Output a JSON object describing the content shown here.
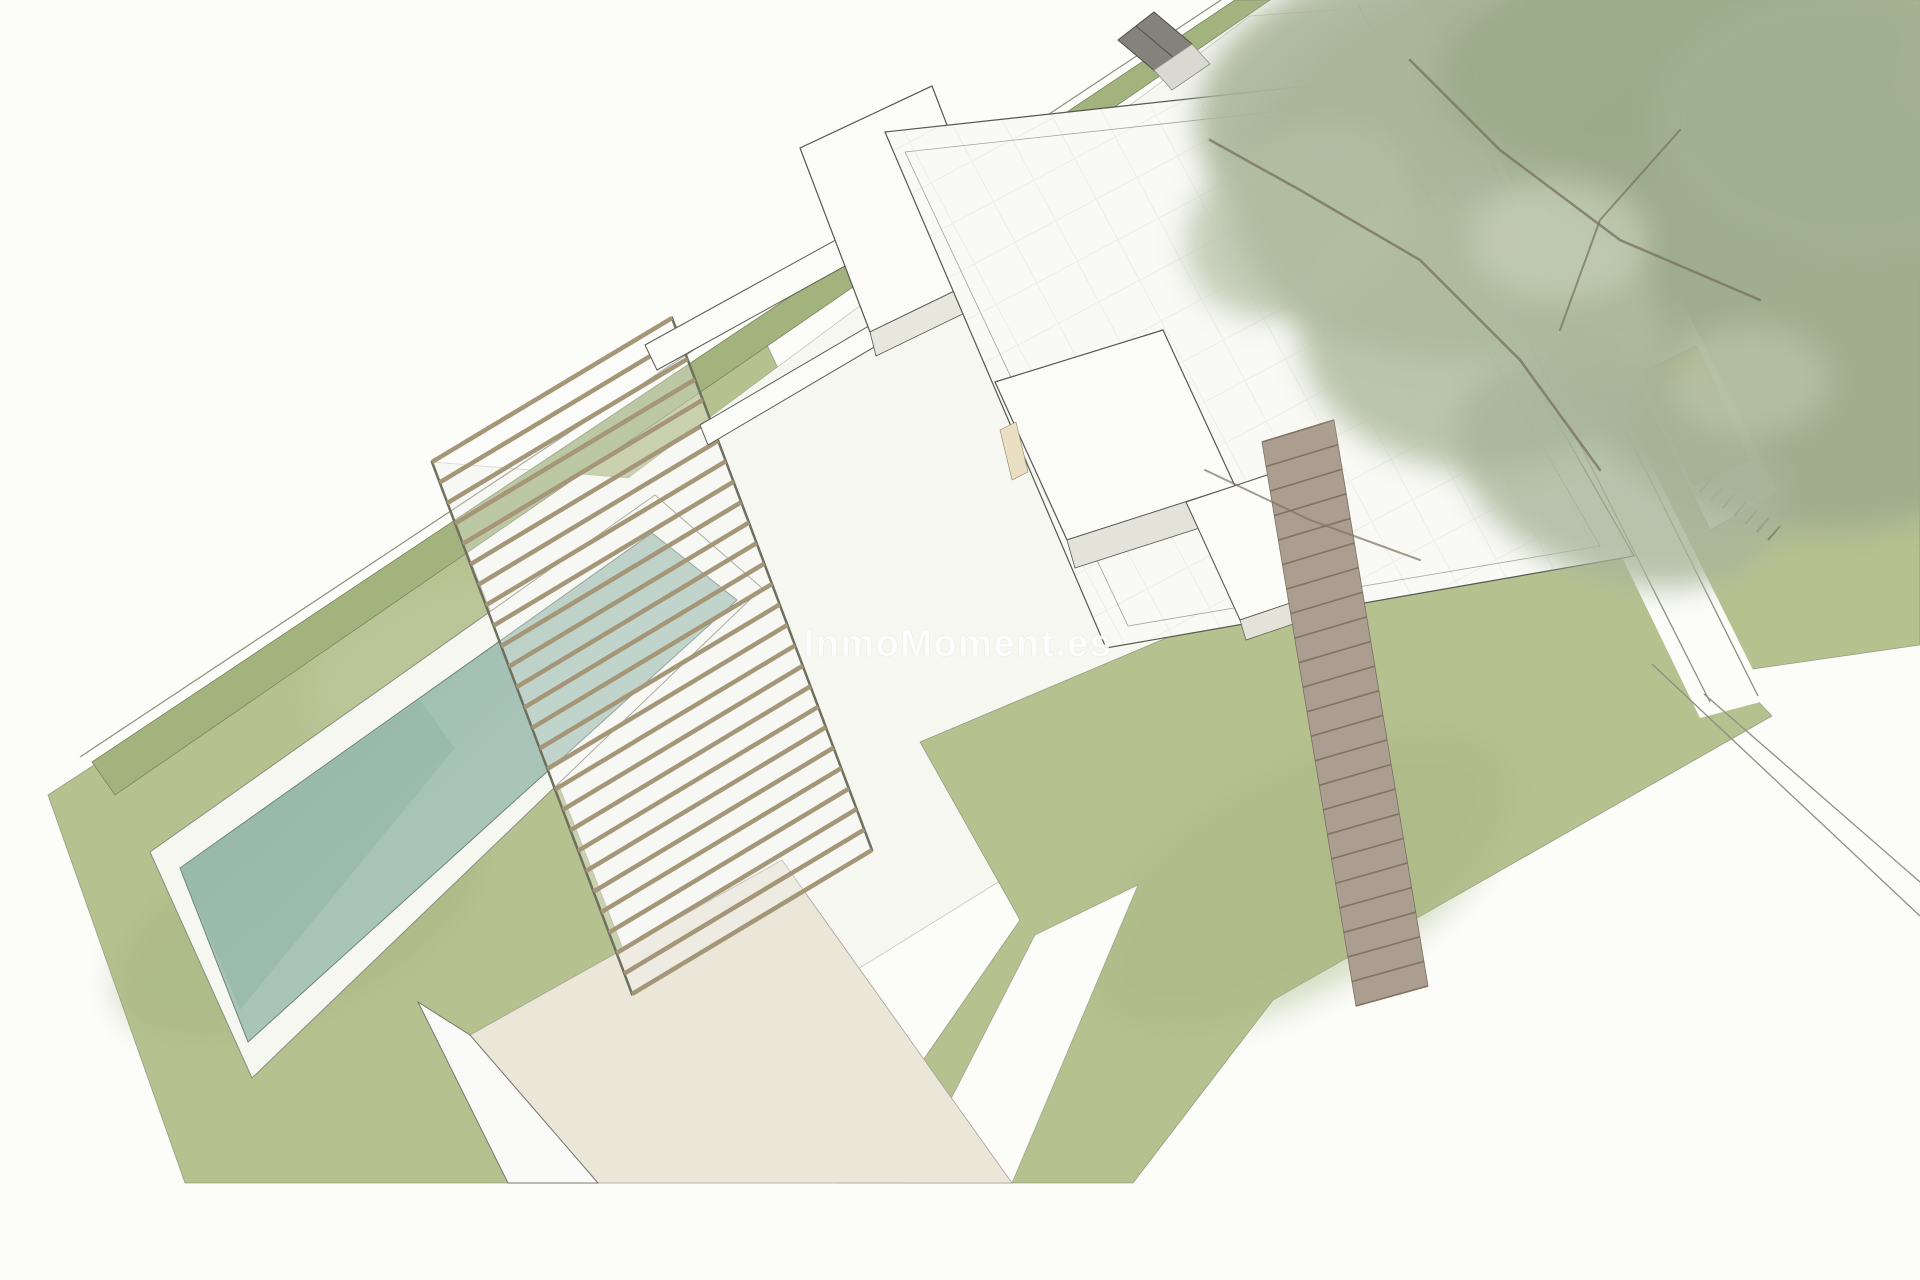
{
  "meta": {
    "description": "Aerial axonometric architectural rendering of a modern villa plot with lawn, pool, pergola, flat-roofed volumes, access ramp, large pine tree and garden furniture",
    "canvas_width": 1920,
    "canvas_height": 1280
  },
  "watermark": {
    "text": "InmoMoment.es",
    "x": 958,
    "y": 656,
    "font_size": 38,
    "fill": "#ffffff",
    "opacity": 0.85,
    "stroke": "rgba(185,185,178,0.28)"
  },
  "palette": {
    "paper": "#fcfcf9",
    "lawn": "#b6c190",
    "lawn_edge": "rgba(105,112,90,0.55)",
    "hedge": "#a3b37e",
    "paving": "#f7f7f2",
    "volume_white": "#fbfbf8",
    "volume_outline": "#56584e",
    "pool_teal": "#9fbfb3",
    "pergola_slat": "#a69678",
    "ramp_brown": "#ab9d8f",
    "beige_terrace": "#eae7d9",
    "tree_green": "#a6b296",
    "lounger_orange": "#dfa33e",
    "hut_grey": "#83827c",
    "path_line": "#8c9080"
  },
  "scene": {
    "shapes": [
      {
        "name": "lawn-west",
        "type": "polygon",
        "points": "48,795 760,330 808,432 560,1183 185,1183",
        "fill": "#b6c190",
        "stroke": "rgba(105,112,90,0.55)",
        "width": 0.8
      },
      {
        "name": "lawn-east",
        "type": "polygon",
        "points": "1400,0 1920,0 1920,645 1662,682 1452,138",
        "fill": "#b6c190",
        "stroke": "rgba(105,112,90,0.55)",
        "width": 0.8
      },
      {
        "name": "lawn-mottle-light",
        "type": "ellipse",
        "cx": 450,
        "cy": 660,
        "rx": 150,
        "ry": 80,
        "rot": -20,
        "fill": "#c2cba4",
        "opacity": 0.4,
        "filter": "soft"
      },
      {
        "name": "lawn-mottle-dark",
        "type": "ellipse",
        "cx": 300,
        "cy": 920,
        "rx": 200,
        "ry": 95,
        "rot": -25,
        "fill": "#a6b682",
        "opacity": 0.45,
        "filter": "soft"
      },
      {
        "name": "central-paving",
        "type": "polygon",
        "points": "432,462 628,478 1250,16 1360,8 1680,610 1642,668 1400,740 1050,850 800,1005 640,992",
        "fill": "#f7f7f2",
        "stroke": "rgba(120,125,108,0.4)",
        "width": 0.8
      },
      {
        "name": "lawn-south",
        "type": "polygon",
        "points": "920,742 1545,478 1772,716 1273,1000 1133,1183 838,1183 1020,920",
        "fill": "#b6c190",
        "stroke": "rgba(105,112,90,0.55)",
        "width": 0.8
      },
      {
        "name": "lawn-south-mottle",
        "type": "ellipse",
        "cx": 1300,
        "cy": 880,
        "rx": 240,
        "ry": 110,
        "rot": -30,
        "fill": "#a8b884",
        "opacity": 0.45,
        "filter": "soft"
      },
      {
        "name": "garden-path",
        "type": "polygon",
        "points": "1035,935 1138,885 1012,1183 908,1183",
        "fill": "#fcfcf9",
        "stroke": "rgba(120,125,108,0.5)",
        "width": 0.8
      },
      {
        "name": "driveway-road",
        "type": "polygon",
        "points": "1352,0 1420,0 1768,700 1700,718",
        "fill": "#fcfcf9",
        "stroke": "none",
        "width": 0
      },
      {
        "name": "boundary-line-outer",
        "type": "line",
        "x1": 80,
        "y1": 757,
        "x2": 1230,
        "y2": -6,
        "stroke": "#8c9080",
        "width": 1.2
      },
      {
        "name": "road-edge-left",
        "type": "line",
        "x1": 1358,
        "y1": 4,
        "x2": 1710,
        "y2": 702,
        "stroke": "#8c9080",
        "width": 1.3
      },
      {
        "name": "road-edge-right",
        "type": "line",
        "x1": 1412,
        "y1": 2,
        "x2": 1758,
        "y2": 696,
        "stroke": "#8c9080",
        "width": 1.3
      },
      {
        "name": "junction-line-a",
        "type": "line",
        "x1": 1704,
        "y1": 694,
        "x2": 1920,
        "y2": 882,
        "stroke": "#8c9080",
        "width": 1.3
      },
      {
        "name": "junction-line-b",
        "type": "line",
        "x1": 1652,
        "y1": 664,
        "x2": 1920,
        "y2": 916,
        "stroke": "#8c9080",
        "width": 1.3
      },
      {
        "name": "hedge-strip",
        "type": "polygon",
        "points": "92,762 1235,0 1270,0 115,795",
        "fill": "#a3b37e",
        "stroke": "#79855f",
        "width": 0.8
      },
      {
        "name": "pool-deck",
        "type": "polygon",
        "points": "150,852 655,495 762,588 252,1078",
        "fill": "#f7f7f2",
        "stroke": "#8a8e7e",
        "width": 1
      },
      {
        "name": "pool-water",
        "type": "polygon",
        "points": "180,868 652,533 737,600 248,1042",
        "fill": "url(#gwater)",
        "stroke": "#6a857a",
        "width": 1
      },
      {
        "name": "pool-water-shade",
        "type": "polygon",
        "points": "180,868 420,700 455,748 240,1010",
        "fill": "#8fb2a4",
        "stroke": "none",
        "width": 0,
        "opacity": 0.45
      },
      {
        "name": "sunken-terrace",
        "type": "polygon",
        "points": "470,1035 782,860 1012,1183 598,1183",
        "fill": "#eae7d9",
        "stroke": "#a2a294",
        "width": 0.8
      },
      {
        "name": "terrace-wall",
        "type": "polygon",
        "points": "418,1002 470,1035 598,1183 508,1183",
        "fill": "#fafaf8",
        "stroke": "#75786a",
        "width": 1
      },
      {
        "name": "pergola-frame",
        "type": "polygon",
        "points": "432,462 672,318 872,850 632,994",
        "fill": "rgba(250,250,247,0.3)",
        "stroke": "#6e705f",
        "width": 2.5
      },
      {
        "name": "pergola-slats",
        "type": "slats",
        "a1": [
          432,
          462
        ],
        "a2": [
          632,
          994
        ],
        "b1": [
          672,
          318
        ],
        "b2": [
          872,
          850
        ],
        "count": 27,
        "stroke": "#a69678",
        "width": 4.5
      },
      {
        "name": "north-garden-wall-1",
        "type": "polygon",
        "points": "645,345 1068,112 1080,136 657,370",
        "fill": "#fbfbf8",
        "stroke": "#5b5e52",
        "width": 1
      },
      {
        "name": "north-garden-wall-2",
        "type": "polygon",
        "points": "700,425 1092,195 1100,214 708,445",
        "fill": "#fbfbf8",
        "stroke": "#5b5e52",
        "width": 1
      },
      {
        "name": "tower-volume",
        "type": "polygon",
        "points": "800,148 932,86 1002,268 870,332",
        "fill": "#fbfbf8",
        "stroke": "#56584e",
        "width": 1.2
      },
      {
        "name": "tower-south-face",
        "type": "polygon",
        "points": "870,332 1002,268 1008,292 876,356",
        "fill": "#e8e7de",
        "stroke": "#56584e",
        "width": 0.8
      },
      {
        "name": "tower-window",
        "type": "polygon",
        "points": "962,262 988,250 996,280 970,292",
        "fill": "#eadfc2",
        "stroke": "#8f8568",
        "width": 0.6
      },
      {
        "name": "main-roof",
        "type": "polygon",
        "points": "885,132 1362,80 1634,556 1106,648",
        "fill": "url(#roofgrid)",
        "stroke": "#56584e",
        "width": 1.2
      },
      {
        "name": "main-roof-parapet",
        "type": "polygon",
        "points": "905,152 1345,104 1600,546 1128,626",
        "fill": "none",
        "stroke": "#a2a596",
        "width": 0.8
      },
      {
        "name": "patio-cube-a",
        "type": "polygon",
        "points": "995,382 1163,330 1235,486 1067,540",
        "fill": "#fbfbf8",
        "stroke": "#56584e",
        "width": 1.2
      },
      {
        "name": "patio-cube-a-face",
        "type": "polygon",
        "points": "1067,540 1235,486 1243,514 1075,568",
        "fill": "#e4e3da",
        "stroke": "#56584e",
        "width": 0.8
      },
      {
        "name": "patio-cube-a-window",
        "type": "polygon",
        "points": "1000,430 1016,422 1028,472 1012,480",
        "fill": "#eadfc2",
        "stroke": "#8f8568",
        "width": 0.6
      },
      {
        "name": "patio-cube-b",
        "type": "polygon",
        "points": "1186,502 1300,464 1353,582 1240,620",
        "fill": "#fbfbf8",
        "stroke": "#56584e",
        "width": 1.1
      },
      {
        "name": "patio-cube-b-face",
        "type": "polygon",
        "points": "1240,620 1353,582 1358,602 1246,640",
        "fill": "#e4e3da",
        "stroke": "#56584e",
        "width": 0.7
      },
      {
        "name": "access-ramp",
        "type": "polygon",
        "points": "1262,442 1334,420 1428,986 1356,1006",
        "fill": "#ab9d8f",
        "stroke": "#7c7164",
        "width": 0.8
      },
      {
        "name": "access-ramp-stripes",
        "type": "slats",
        "a1": [
          1262,
          442
        ],
        "a2": [
          1356,
          1006
        ],
        "b1": [
          1334,
          420
        ],
        "b2": [
          1428,
          986
        ],
        "count": 24,
        "stroke": "#80735f",
        "width": 1.6
      },
      {
        "name": "lounger-pad",
        "type": "polygon",
        "points": "1612,332 1680,296 1778,492 1710,530",
        "fill": "#f6f6f1",
        "stroke": "#999c8e",
        "width": 0.8
      },
      {
        "name": "garden-lounger",
        "type": "polygon",
        "points": "1643,372 1697,346 1748,460 1694,486",
        "fill": "#dfa33e",
        "stroke": "#8a6a28",
        "width": 1
      },
      {
        "name": "step-hatching",
        "type": "slats",
        "a1": [
          1700,
          492
        ],
        "a2": [
          1768,
          540
        ],
        "b1": [
          1712,
          478
        ],
        "b2": [
          1780,
          526
        ],
        "count": 7,
        "stroke": "#4a4a42",
        "width": 2
      },
      {
        "name": "tree-canopy-1",
        "type": "ellipse",
        "cx": 1555,
        "cy": 150,
        "rx": 330,
        "ry": 200,
        "rot": -15,
        "fill": "#a6b296",
        "opacity": 0.95,
        "filter": "soft"
      },
      {
        "name": "tree-canopy-2",
        "type": "ellipse",
        "cx": 1810,
        "cy": 300,
        "rx": 280,
        "ry": 230,
        "rot": 10,
        "fill": "#9fac8e",
        "opacity": 0.9,
        "filter": "soft"
      },
      {
        "name": "tree-canopy-3",
        "type": "ellipse",
        "cx": 1370,
        "cy": 90,
        "rx": 180,
        "ry": 120,
        "rot": -20,
        "fill": "#aab59a",
        "opacity": 0.9,
        "filter": "soft"
      },
      {
        "name": "tree-canopy-4",
        "type": "ellipse",
        "cx": 1680,
        "cy": 60,
        "rx": 240,
        "ry": 110,
        "rot": -5,
        "fill": "#9bab89",
        "opacity": 0.9,
        "filter": "soft"
      },
      {
        "name": "tree-canopy-5",
        "type": "ellipse",
        "cx": 1480,
        "cy": 330,
        "rx": 180,
        "ry": 140,
        "rot": 0,
        "fill": "#b0bca0",
        "opacity": 0.85,
        "filter": "soft"
      },
      {
        "name": "tree-canopy-6",
        "type": "ellipse",
        "cx": 1850,
        "cy": 120,
        "rx": 200,
        "ry": 140,
        "rot": 0,
        "fill": "#a2b092",
        "opacity": 0.9,
        "filter": "soft"
      },
      {
        "name": "tree-canopy-7",
        "type": "ellipse",
        "cx": 1620,
        "cy": 470,
        "rx": 170,
        "ry": 110,
        "rot": 20,
        "fill": "#a8b59a",
        "opacity": 0.8,
        "filter": "soft"
      },
      {
        "name": "tree-canopy-8",
        "type": "ellipse",
        "cx": 1300,
        "cy": 220,
        "rx": 120,
        "ry": 90,
        "rot": -30,
        "fill": "#b4bfa4",
        "opacity": 0.75,
        "filter": "soft"
      },
      {
        "name": "tree-canopy-highlight-1",
        "type": "ellipse",
        "cx": 1560,
        "cy": 240,
        "rx": 90,
        "ry": 60,
        "rot": 0,
        "fill": "#c6cfb6",
        "opacity": 0.7,
        "filter": "soft"
      },
      {
        "name": "tree-canopy-highlight-2",
        "type": "ellipse",
        "cx": 1750,
        "cy": 380,
        "rx": 80,
        "ry": 55,
        "rot": 0,
        "fill": "#c0c9ae",
        "opacity": 0.6,
        "filter": "soft"
      },
      {
        "name": "tree-branch-1",
        "type": "polyline",
        "points": "1210,140 1300,190 1420,260 1520,360 1600,470",
        "stroke": "#7a7460",
        "width": 2.5,
        "opacity": 0.8
      },
      {
        "name": "tree-branch-2",
        "type": "polyline",
        "points": "1410,60 1500,150 1620,240 1760,300",
        "stroke": "#7a7460",
        "width": 2.5,
        "opacity": 0.8
      },
      {
        "name": "tree-branch-3",
        "type": "polyline",
        "points": "1680,130 1600,220 1560,330",
        "stroke": "#7a7460",
        "width": 2,
        "opacity": 0.75
      },
      {
        "name": "tree-branch-4",
        "type": "polyline",
        "points": "1205,470 1310,520 1420,560",
        "stroke": "#7a7460",
        "width": 2,
        "opacity": 0.7
      },
      {
        "name": "garden-hut-roof",
        "type": "polygon",
        "points": "1118,40 1154,12 1192,44 1156,72",
        "fill": "#83827c",
        "stroke": "#4f4e48",
        "width": 1
      },
      {
        "name": "garden-hut-ridge",
        "type": "line",
        "x1": 1136,
        "y1": 26,
        "x2": 1174,
        "y2": 58,
        "stroke": "#4f4e48",
        "width": 1
      },
      {
        "name": "garden-hut-porch",
        "type": "polygon",
        "points": "1154,70 1192,44 1210,64 1172,90",
        "fill": "#d9d9d2",
        "stroke": "#8b8b84",
        "width": 0.8
      },
      {
        "name": "drawing-bottom-cut",
        "type": "polygon",
        "points": "0,1185 1920,1185 1920,1280 0,1280",
        "fill": "#fcfcf9",
        "stroke": "none",
        "width": 0
      }
    ]
  }
}
